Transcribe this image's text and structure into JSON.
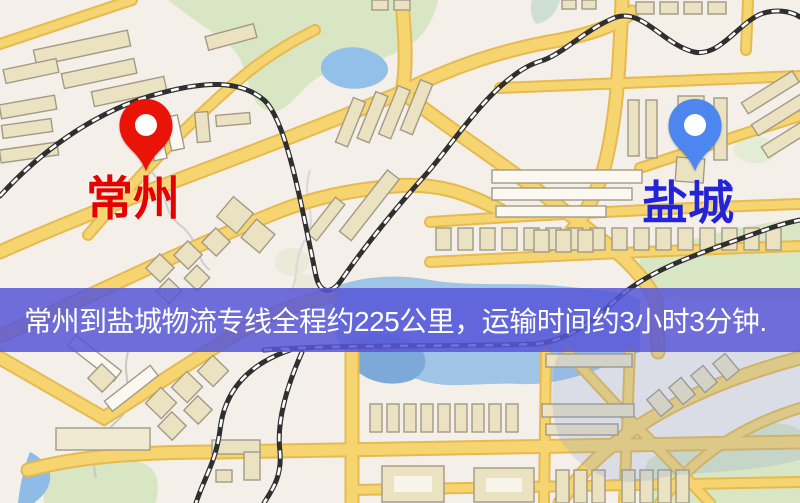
{
  "map": {
    "markers": [
      {
        "name": "changzhou",
        "label": "常州",
        "pin_color": "#ea1308",
        "label_color": "#e60000"
      },
      {
        "name": "yancheng",
        "label": "盐城",
        "pin_color": "#4c86ee",
        "label_color": "#2424d6"
      }
    ],
    "banner": {
      "text": "常州到盐城物流专线全程约225公里，运输时间约3小时3分钟.",
      "background": "rgba(86,86,215,0.85)",
      "text_color": "#ffffff"
    },
    "colors": {
      "map_background": "#f4efe8",
      "road_fill": "#f6d571",
      "road_casing": "#e5ba50",
      "building": "#ebe2c1",
      "park": "#d9e6c3",
      "water": "#93c0e8",
      "railway": "#2f2f2f"
    }
  }
}
